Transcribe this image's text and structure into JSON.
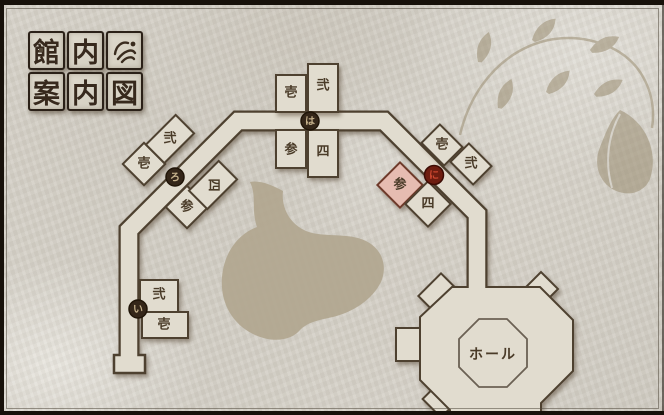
{
  "title_board": {
    "tiles": [
      "館",
      "内",
      "案",
      "内",
      "図"
    ],
    "crest_icon": "brush-crest"
  },
  "map": {
    "hall_label": "ホール",
    "markers": {
      "i": "い",
      "ro": "ろ",
      "ha": "は",
      "ni": "に"
    },
    "clusters": {
      "i": {
        "rooms": {
          "r1": "壱",
          "r2": "弐"
        }
      },
      "ro": {
        "rooms": {
          "r1": "壱",
          "r2": "弐",
          "r3": "参",
          "r4": "四"
        }
      },
      "ha": {
        "rooms": {
          "r1": "壱",
          "r2": "弐",
          "r3": "参",
          "r4": "四"
        }
      },
      "ni": {
        "rooms": {
          "r1": "壱",
          "r2": "弐",
          "r3": "参",
          "r4": "四"
        },
        "current_room_label": "参"
      }
    }
  },
  "colors": {
    "paper": "#d5d1c8",
    "floor": "#e1dccf",
    "outline": "#4e4130",
    "room_text": "#4a3b28",
    "highlight_room_fill": "#e6bcb1",
    "highlight_room_stroke": "#6e3a2a",
    "highlight_room_text": "#a13a2b",
    "marker_fill": "#342619",
    "marker_text": "#c6b28c",
    "current_marker_fill": "#6e1d10",
    "current_marker_text": "#cd4730",
    "stain": "#b0a58e",
    "decoration": "#9b8e72"
  }
}
